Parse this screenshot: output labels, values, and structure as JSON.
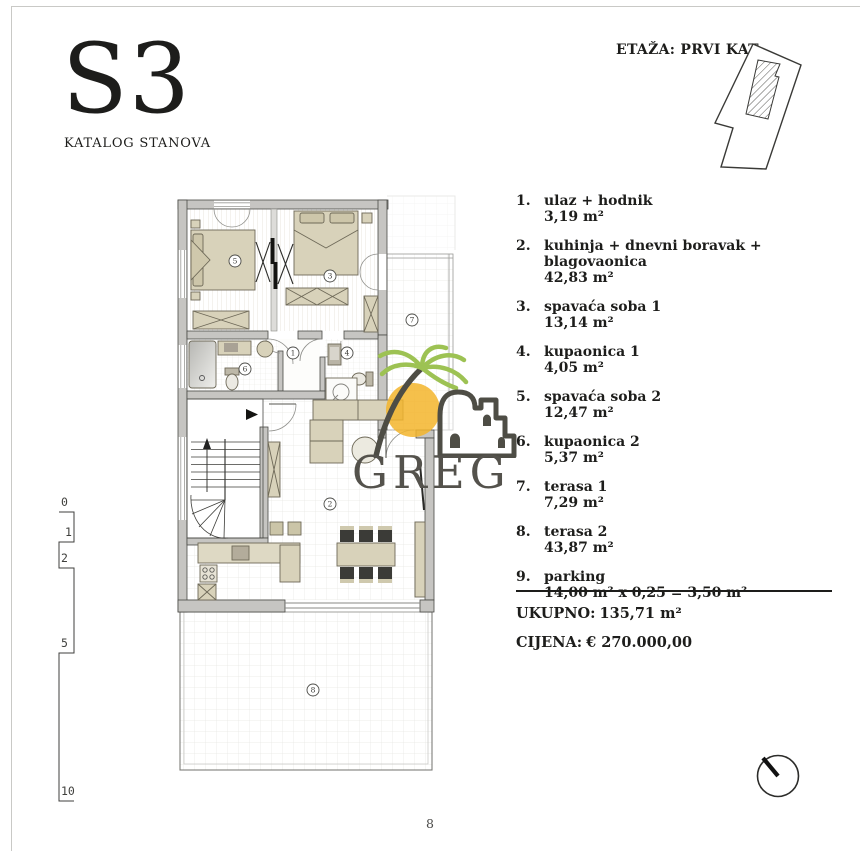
{
  "header": {
    "unit_code": "S3",
    "catalog_label": "KATALOG STANOVA",
    "floor_label": "ETAŽA: PRVI KAT"
  },
  "legend": {
    "rooms": [
      {
        "id": "1",
        "num": "1.",
        "name": "ulaz + hodnik",
        "area": "3,19 m²"
      },
      {
        "id": "2",
        "num": "2.",
        "name": "kuhinja + dnevni boravak + blagovaonica",
        "area": "42,83 m²"
      },
      {
        "id": "3",
        "num": "3.",
        "name": "spavaća soba 1",
        "area": "13,14 m²"
      },
      {
        "id": "4",
        "num": "4.",
        "name": "kupaonica 1",
        "area": "4,05 m²"
      },
      {
        "id": "5",
        "num": "5.",
        "name": "spavaća soba 2",
        "area": "12,47 m²"
      },
      {
        "id": "6",
        "num": "6.",
        "name": "kupaonica 2",
        "area": "5,37 m²"
      },
      {
        "id": "7",
        "num": "7.",
        "name": "terasa 1",
        "area": "7,29 m²"
      },
      {
        "id": "8",
        "num": "8.",
        "name": "terasa 2",
        "area": "43,87 m²"
      },
      {
        "id": "9",
        "num": "9.",
        "name": "parking",
        "area": "14,00 m² x 0,25 = 3,50 m²"
      }
    ],
    "total_label": "UKUPNO:",
    "total_value": "135,71 m²",
    "price_label": "CIJENA:",
    "price_value": "€ 270.000,00"
  },
  "plan": {
    "room_markers": [
      "1",
      "2",
      "3",
      "4",
      "5",
      "6",
      "7",
      "8"
    ]
  },
  "scalebar": {
    "labels": [
      "0",
      "1",
      "2",
      "5",
      "10"
    ]
  },
  "watermark": {
    "brand": "GREG"
  },
  "page": {
    "number": "8"
  },
  "colors": {
    "wall": "#c6c5c2",
    "furniture": "#d8d2ba",
    "sun_yellow": "#f3b52b",
    "palm_green": "#9dc253",
    "watermark_gray": "#54524c"
  }
}
